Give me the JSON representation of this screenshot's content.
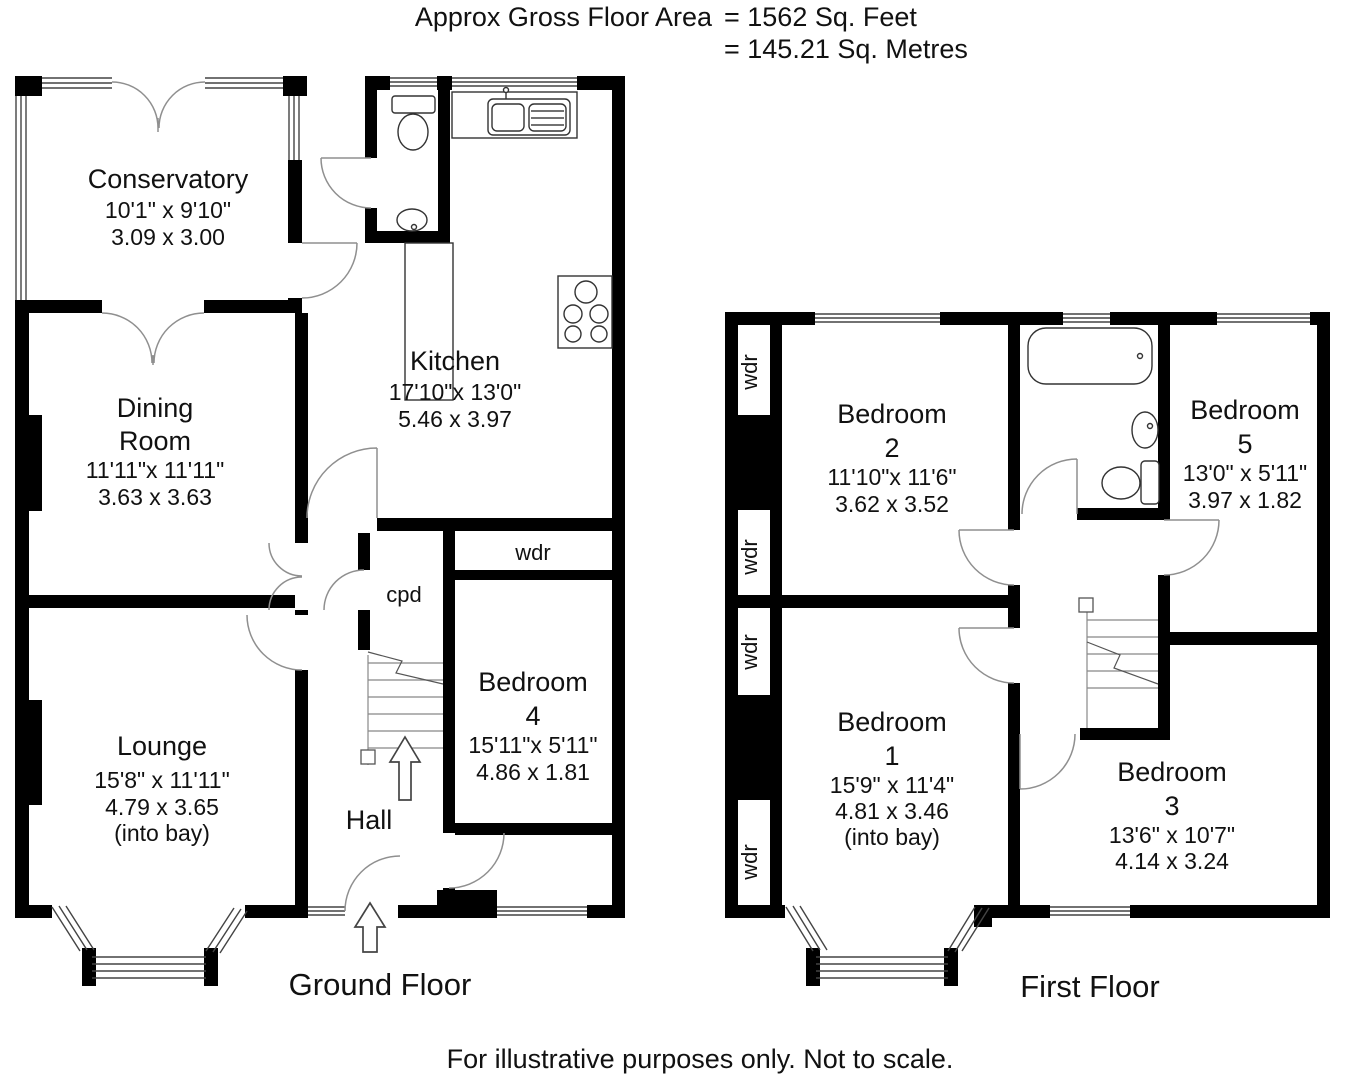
{
  "header": {
    "area_label": "Approx Gross Floor Area",
    "feet": "=  1562  Sq. Feet",
    "metres": "=  145.21  Sq. Metres"
  },
  "footer": {
    "disclaimer": "For illustrative purposes only. Not to scale."
  },
  "ground_floor": {
    "label": "Ground Floor",
    "conservatory": {
      "name": "Conservatory",
      "imperial": "10'1\" x 9'10\"",
      "metric": "3.09  x  3.00"
    },
    "dining_room": {
      "name_line1": "Dining",
      "name_line2": "Room",
      "imperial": "11'11\"x 11'11\"",
      "metric": "3.63  x  3.63"
    },
    "kitchen": {
      "name": "Kitchen",
      "imperial": "17'10\"x 13'0\"",
      "metric": "5.46  x  3.97"
    },
    "lounge": {
      "name": "Lounge",
      "imperial": "15'8\" x 11'11\"",
      "metric": "4.79  x  3.65",
      "note": "(into bay)"
    },
    "bedroom4": {
      "name_line1": "Bedroom",
      "name_line2": "4",
      "imperial": "15'11\"x 5'11\"",
      "metric": "4.86  x  1.81"
    },
    "hall": {
      "name": "Hall"
    },
    "cpd": {
      "name": "cpd"
    },
    "wdr": {
      "name": "wdr"
    }
  },
  "first_floor": {
    "label": "First Floor",
    "wdr_label": "wdr",
    "bedroom2": {
      "name_line1": "Bedroom",
      "name_line2": "2",
      "imperial": "11'10\"x 11'6\"",
      "metric": "3.62  x  3.52"
    },
    "bedroom5": {
      "name_line1": "Bedroom",
      "name_line2": "5",
      "imperial": "13'0\" x 5'11\"",
      "metric": "3.97  x  1.82"
    },
    "bedroom1": {
      "name_line1": "Bedroom",
      "name_line2": "1",
      "imperial": "15'9\" x 11'4\"",
      "metric": "4.81  x  3.46",
      "note": "(into bay)"
    },
    "bedroom3": {
      "name_line1": "Bedroom",
      "name_line2": "3",
      "imperial": "13'6\" x 10'7\"",
      "metric": "4.14  x  3.24"
    }
  }
}
